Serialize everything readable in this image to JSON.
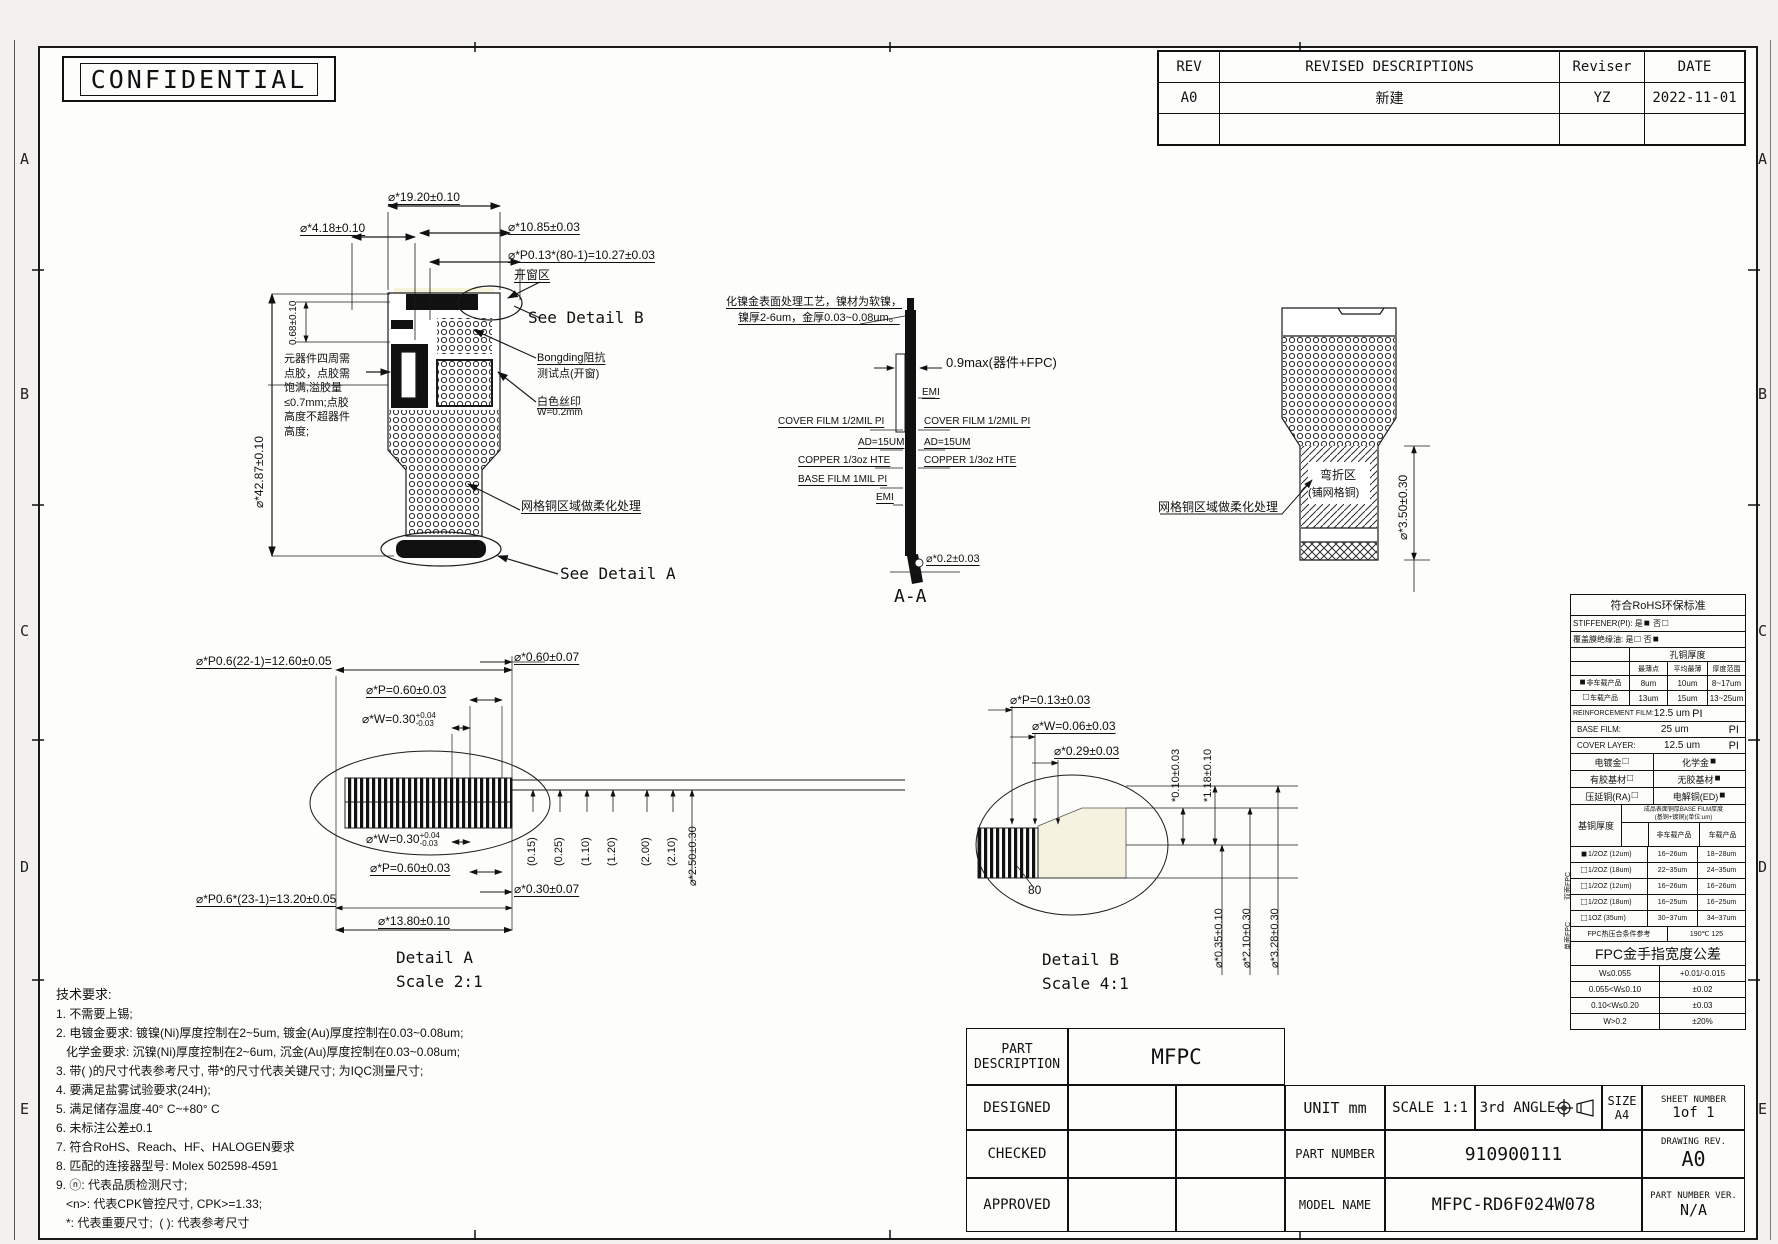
{
  "confidential": "CONFIDENTIAL",
  "zones": [
    "A",
    "B",
    "C",
    "D",
    "E"
  ],
  "colors": {
    "line": "#1a1a1a",
    "paper": "#fdfdfb",
    "highlight": "#f6f3da",
    "pad_fill": "#f6f2e0"
  },
  "revision": {
    "headers": [
      "REV",
      "REVISED DESCRIPTIONS",
      "Reviser",
      "DATE"
    ],
    "rows": [
      [
        "A0",
        "新建",
        "YZ",
        "2022-11-01"
      ]
    ]
  },
  "main_view": {
    "dim_19": "⌀*19.20±0.10",
    "dim_418": "⌀*4.18±0.10",
    "dim_068": "0.68±0.10",
    "dim_1085": "⌀*10.85±0.03",
    "dim_p013": "⌀*P0.13*(80-1)=10.27±0.03",
    "dim_4287": "⌀*42.87±0.10",
    "lbl_window": "开窗区",
    "lbl_see_b": "See Detail B",
    "lbl_bonding1": "Bongding阻抗",
    "lbl_bonding2": "测试点(开窗)",
    "lbl_silk1": "白色丝印",
    "lbl_silk2": "W=0.2mm",
    "lbl_mesh": "网格铜区域做柔化处理",
    "lbl_see_a": "See Detail A",
    "note_glue": "元器件四周需\n点胶，点胶需\n饱满,溢胶量\n≤0.7mm;点胶\n高度不超器件\n高度;"
  },
  "section": {
    "note1": "化镍金表面处理工艺，镍材为软镍，",
    "note2": "镍厚2-6um，金厚0.03~0.08um。",
    "dim_09": "0.9max(器件+FPC)",
    "emi_r": "EMI",
    "cover_l": "COVER FILM 1/2MIL PI",
    "cover_r": "COVER FILM 1/2MIL PI",
    "ad_l": "AD=15UM",
    "ad_r": "AD=15UM",
    "copper_l": "COPPER 1/3oz HTE",
    "copper_r": "COPPER 1/3oz HTE",
    "base_l": "BASE FILM 1MIL PI",
    "emi_l": "EMI",
    "dim_02": "⌀*0.2±0.03",
    "title": "A-A"
  },
  "bend": {
    "lbl_mesh": "网格铜区域做柔化处理",
    "zone1": "弯折区",
    "zone2": "(铺网格铜)",
    "dim_350": "⌀*3.50±0.30"
  },
  "detail_a": {
    "dim_p06_22": "⌀*P0.6(22-1)=12.60±0.05",
    "dim_060": "⌀*0.60±0.07",
    "dim_p_top": "⌀*P=0.60±0.03",
    "w_main": "⌀*W=0.30",
    "w_up": "+0.04",
    "w_dn": "-0.03",
    "dim_p_bot": "⌀*P=0.60±0.03",
    "dim_030": "⌀*0.30±0.07",
    "dim_p06_23": "⌀*P0.6*(23-1)=13.20±0.05",
    "dim_1380": "⌀*13.80±0.10",
    "v_dims": [
      "(0.15)",
      "(0.25)",
      "(1.10)",
      "(1.20)",
      "(2.00)",
      "(2.10)"
    ],
    "dim_250": "⌀*2.50±0.30",
    "title": "Detail A",
    "scale": "Scale 2:1"
  },
  "detail_b": {
    "dim_p013": "⌀*P=0.13±0.03",
    "dim_w006": "⌀*W=0.06±0.03",
    "dim_029": "⌀*0.29±0.03",
    "dim_010": "*0.10±0.03",
    "dim_118": "*1.18±0.10",
    "count": "80",
    "dim_035": "⌀*0.35±0.10",
    "dim_210": "⌀*2.10±0.30",
    "dim_328": "⌀*3.28±0.30",
    "title": "Detail B",
    "scale": "Scale 4:1"
  },
  "spec": {
    "title": "符合RoHS环保标准",
    "stiffener": {
      "label": "STIFFENER(PI):",
      "yes": "是",
      "yes_box": "■",
      "no": "否",
      "no_box": "□"
    },
    "cover_ink": {
      "label": "覆盖膜绝缘油:",
      "yes": "是",
      "yes_box": "□",
      "no": "否",
      "no_box": "■"
    },
    "hole": {
      "title": "孔铜厚度",
      "headers": [
        "最薄点",
        "平均最薄",
        "厚度范围"
      ],
      "rows": [
        {
          "box": "■",
          "label": "非车载产品",
          "c1": "8um",
          "c2": "10um",
          "c3": "8~17um"
        },
        {
          "box": "□",
          "label": "车载产品",
          "c1": "13um",
          "c2": "15um",
          "c3": "13~25um"
        }
      ]
    },
    "films": [
      {
        "label": "REINFORCEMENT FILM:",
        "value": "12.5 um",
        "unit": "PI"
      },
      {
        "label": "BASE FILM:",
        "value": "25 um",
        "unit": "PI"
      },
      {
        "label": "COVER LAYER:",
        "value": "12.5 um",
        "unit": "PI"
      }
    ],
    "options": [
      {
        "l": "电镀金",
        "lb": "□",
        "r": "化学金",
        "rb": "■"
      },
      {
        "l": "有胶基材",
        "lb": "□",
        "r": "无胶基材",
        "rb": "■"
      },
      {
        "l": "压延铜(RA)",
        "lb": "□",
        "r": "电解铜(ED)",
        "rb": "■"
      }
    ],
    "base_copper": {
      "label": "基铜厚度",
      "note1": "成品表面铜厚BASE FILM厚度",
      "note2": "(基铜+镀铜)(单位:um)",
      "col1": "非车载产品",
      "col2": "车载产品",
      "group1": "双面FPC",
      "group2": "单面FPC",
      "rows": [
        {
          "box": "■",
          "oz": "1/2OZ (12um)",
          "a": "16~26um",
          "b": "18~28um"
        },
        {
          "box": "□",
          "oz": "1/2OZ (18um)",
          "a": "22~35um",
          "b": "24~35um"
        },
        {
          "box": "□",
          "oz": "1/2OZ (12um)",
          "a": "16~26um",
          "b": "16~26um"
        },
        {
          "box": "□",
          "oz": "1/2OZ (18um)",
          "a": "16~25um",
          "b": "16~25um"
        },
        {
          "box": "□",
          "oz": "1OZ (35um)",
          "a": "30~37um",
          "b": "34~37um"
        }
      ],
      "press_label": "FPC热压合条件参考",
      "press_value": "190℃ 125"
    },
    "finger": {
      "title": "FPC金手指宽度公差",
      "rows": [
        [
          "W≤0.055",
          "+0.01/-0.015"
        ],
        [
          "0.055<W≤0.10",
          "±0.02"
        ],
        [
          "0.10<W≤0.20",
          "±0.03"
        ],
        [
          "W>0.2",
          "±20%"
        ]
      ]
    }
  },
  "tech": {
    "title": "技术要求:",
    "lines": [
      "1. 不需要上锡;",
      "2. 电镀金要求: 镀镍(Ni)厚度控制在2~5um, 镀金(Au)厚度控制在0.03~0.08um;",
      "   化学金要求: 沉镍(Ni)厚度控制在2~6um, 沉金(Au)厚度控制在0.03~0.08um;",
      "3. 带( )的尺寸代表参考尺寸, 带*的尺寸代表关键尺寸; 为IQC测量尺寸;",
      "4. 要满足盐雾试验要求(24H);",
      "5. 满足储存温度-40° C~+80° C",
      "6. 未标注公差±0.1",
      "7. 符合RoHS、Reach、HF、HALOGEN要求",
      "8. 匹配的连接器型号: Molex 502598-4591",
      "9. ⓝ: 代表品质检测尺寸;",
      "   <n>: 代表CPK管控尺寸, CPK>=1.33;",
      "   *: 代表重要尺寸;  ( ): 代表参考尺寸"
    ]
  },
  "title_block": {
    "part_desc_1": "PART",
    "part_desc_2": "DESCRIPTION",
    "part_desc_value": "MFPC",
    "designed": "DESIGNED",
    "checked": "CHECKED",
    "approved": "APPROVED",
    "unit": "UNIT  mm",
    "scale": "SCALE 1:1",
    "angle": "3rd ANGLE",
    "size_label": "SIZE",
    "size_value": "A4",
    "sheet_label": "SHEET NUMBER",
    "sheet_value": "1of 1",
    "part_number_label": "PART NUMBER",
    "part_number_value": "910900111",
    "drawing_rev_label": "DRAWING REV.",
    "drawing_rev_value": "A0",
    "model_name_label": "MODEL NAME",
    "model_name_value": "MFPC-RD6F024W078",
    "part_ver_label": "PART NUMBER VER.",
    "part_ver_value": "N/A"
  }
}
